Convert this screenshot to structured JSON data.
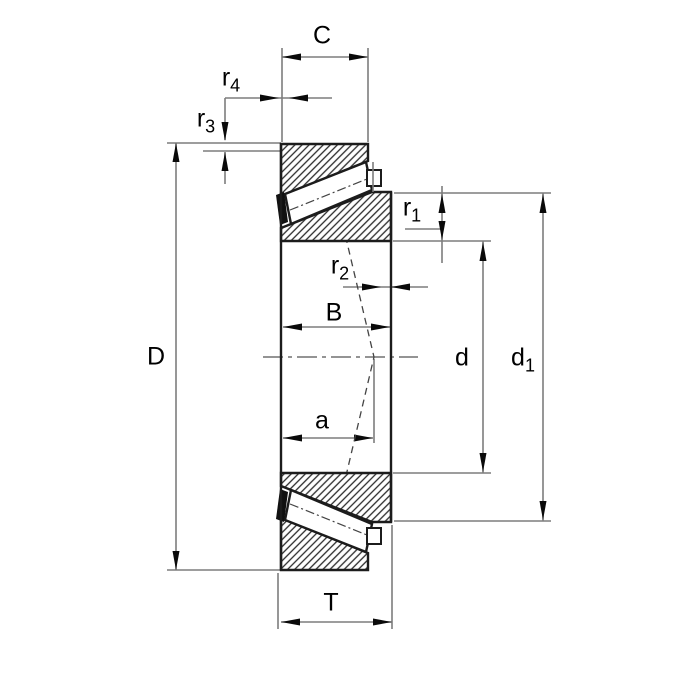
{
  "diagram": {
    "kind": "technical-drawing",
    "subject": "tapered-roller-bearing-cross-section",
    "background_color": "#ffffff",
    "colors": {
      "part_outline": "#1c1c1c",
      "hatch": "#2a2a2a",
      "dimension_lines": "#7d7d7d",
      "text": "#000000"
    },
    "dimension_labels": {
      "C": {
        "base": "C",
        "sub": ""
      },
      "r4": {
        "base": "r",
        "sub": "4"
      },
      "r3": {
        "base": "r",
        "sub": "3"
      },
      "r1": {
        "base": "r",
        "sub": "1"
      },
      "r2": {
        "base": "r",
        "sub": "2"
      },
      "B": {
        "base": "B",
        "sub": ""
      },
      "D": {
        "base": "D",
        "sub": ""
      },
      "d": {
        "base": "d",
        "sub": ""
      },
      "d1": {
        "base": "d",
        "sub": "1"
      },
      "a": {
        "base": "a",
        "sub": ""
      },
      "T": {
        "base": "T",
        "sub": ""
      }
    }
  }
}
